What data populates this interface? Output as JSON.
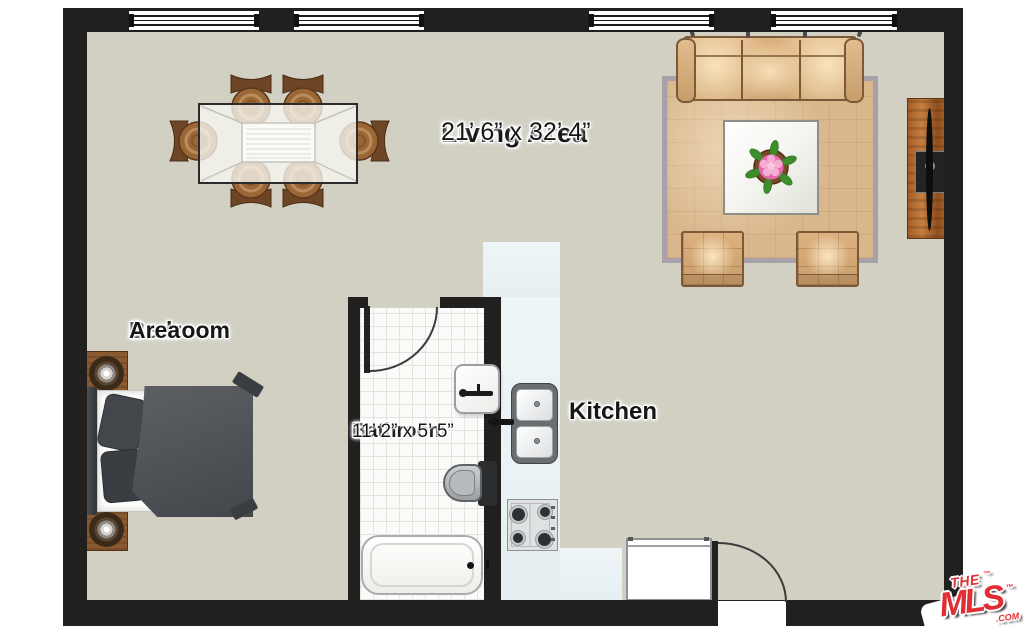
{
  "rooms": {
    "living_area": {
      "name": "Living Area",
      "dims": "21’ 6” x 32’ 4”"
    },
    "bedroom_area": {
      "line1": "Bedroom",
      "line2": "Area"
    },
    "bathroom": {
      "name": "Bathroom",
      "dims": "11’ 2” x 5’ 5”"
    },
    "kitchen": {
      "name": "Kitchen"
    }
  },
  "logo": {
    "the": "THE",
    "mls": "MLS",
    "tm": "™",
    "com": ".COM"
  },
  "furniture_icons": [
    "dining-table",
    "dining-chair",
    "sofa",
    "coffee-table",
    "flower-pot",
    "ottoman",
    "tv-console",
    "double-bed",
    "nightstand-lamp",
    "bathtub",
    "toilet",
    "bathroom-sink",
    "kitchen-double-sink",
    "stove-cooktop",
    "refrigerator",
    "window",
    "door-swing"
  ],
  "colors": {
    "wall": "#221f1f",
    "floor": "#d1d0c3",
    "rug": "#d9b68c",
    "sofa_tan": "#dcb281",
    "kitchen_counter": "#ebf3f5",
    "bathroom_tile": "#fbfbf9",
    "wood": "#9c6736",
    "bed_gray": "#4b4e52",
    "logo_red": "#e02e34"
  }
}
